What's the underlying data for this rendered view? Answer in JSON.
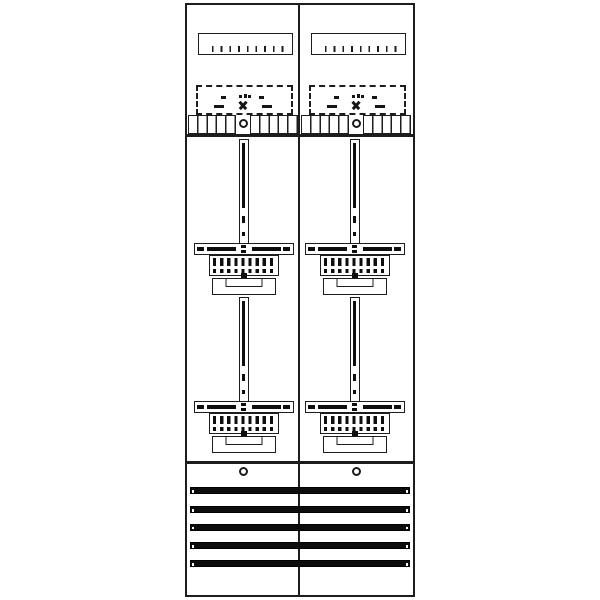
{
  "page": {
    "title": "Two-field meter panel schematic",
    "background": "#ffffff"
  },
  "colors": {
    "line": "#1d1d1d",
    "fill": "#0e0e0e",
    "background": "#ffffff"
  },
  "panel": {
    "columns": 2,
    "top_section": {
      "blocks_per_panel": 2,
      "ruler_tick_count": 10,
      "dashed_mount_outline": true,
      "terminal_comb_groups": 2,
      "terminal_cells_per_group": 5,
      "screw_holes_per_block": 1
    },
    "meter_section": {
      "rows": 2,
      "mount_units": 4,
      "unit_parts": [
        "hanger-rail",
        "cross-rail",
        "terminal-block",
        "mounting-bracket"
      ]
    },
    "bottom_section": {
      "screw_count": 2,
      "busbar_count": 5
    }
  }
}
